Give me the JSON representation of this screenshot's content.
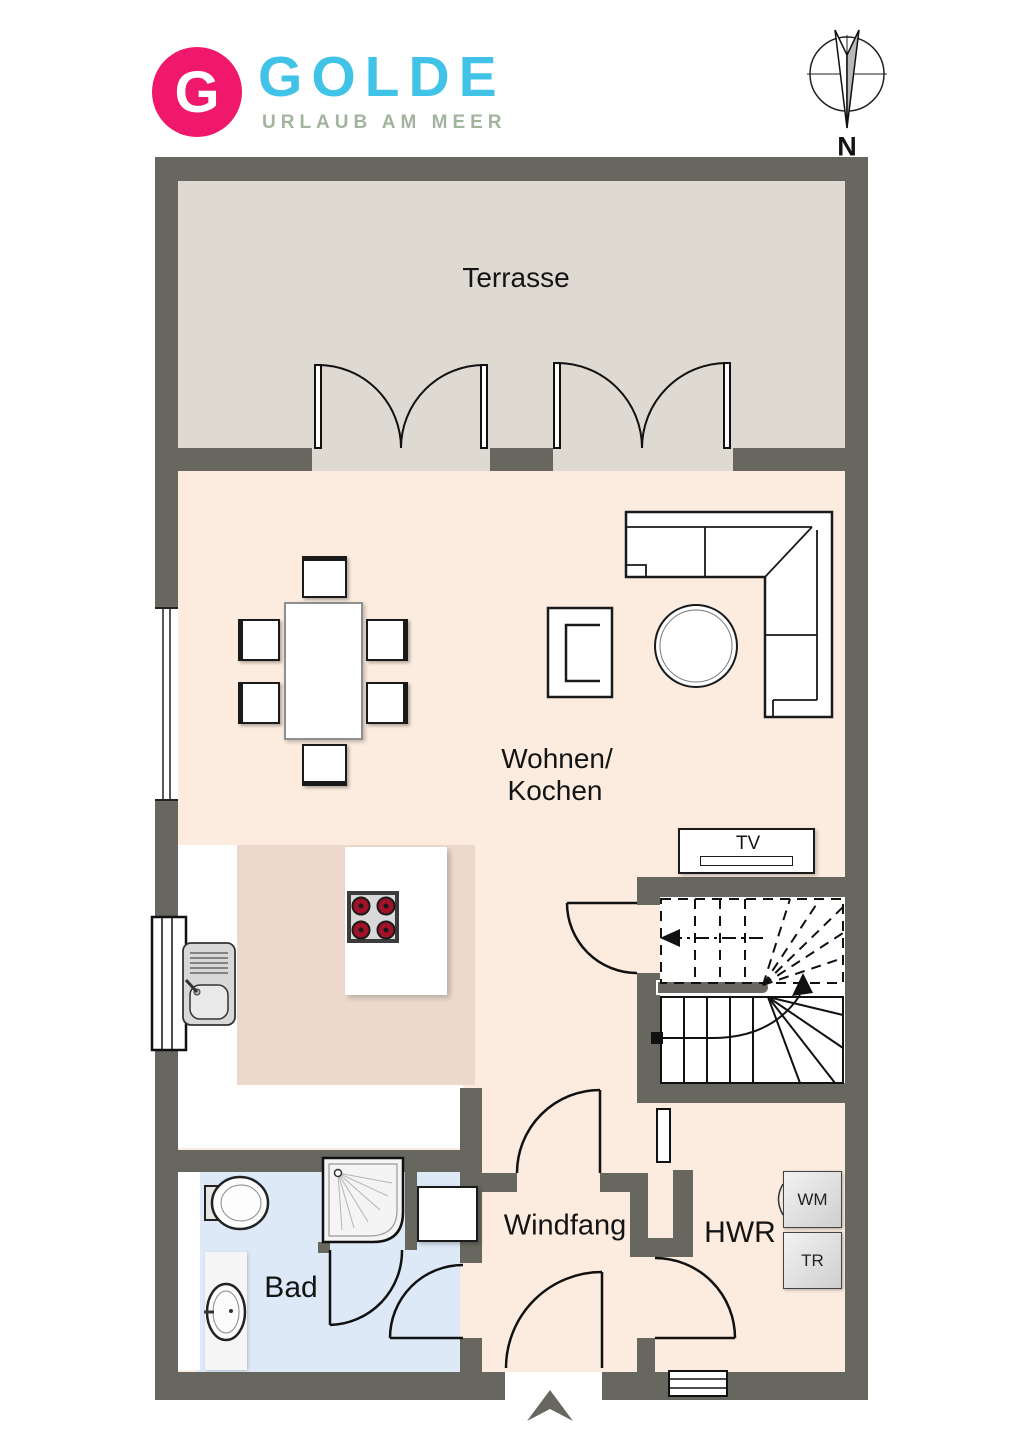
{
  "brand": {
    "initial": "G",
    "name": "GOLDE",
    "tagline": "URLAUB AM MEER",
    "pink": "#f0186c",
    "cyan": "#41c3e8",
    "sage": "#a2b49e"
  },
  "compass": {
    "north_label": "N"
  },
  "rooms": {
    "terrace": {
      "label": "Terrasse"
    },
    "living": {
      "label_line1": "Wohnen/",
      "label_line2": "Kochen"
    },
    "bath": {
      "label": "Bad"
    },
    "vestibule": {
      "label": "Windfang"
    },
    "utility": {
      "label": "HWR"
    }
  },
  "appliances": {
    "tv": {
      "label": "TV"
    },
    "washing_machine": {
      "label": "WM"
    },
    "dryer": {
      "label": "TR"
    }
  },
  "palette": {
    "wall": "#67675f",
    "terrace_floor": "#dedad2",
    "living_floor": "#fcecdf",
    "kitchen_floor": "#ecd9cb",
    "bath_floor": "#dde9f7",
    "burner_red": "#a21126"
  }
}
